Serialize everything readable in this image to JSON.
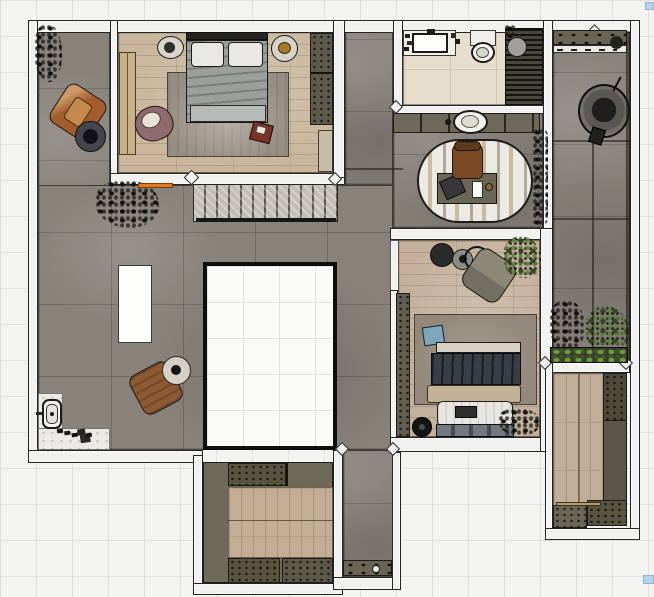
{
  "view": {
    "type": "top-down-floor-plan-render",
    "canvas_width_px": 654,
    "canvas_height_px": 597,
    "visible_text": "none"
  },
  "palette": {
    "background": "#f3f3f1",
    "wall": "#f1f1ef",
    "wall_outline": "#232323",
    "concrete_floor": "#88827b",
    "wood_floor": "#c9b69c",
    "bathroom_marble": "#e7ddcd",
    "entry_marble": "#ebe9e4",
    "cabinet_olive": "#6e695a",
    "cabinet_olive_dark": "#59533f",
    "void_fill": "#fafaf9",
    "accent_orange_mat": "#e5791e",
    "bed2_duvet_navy": "#383e45",
    "bed2_blanket_beige": "#c2b097",
    "cushion_blue": "#7fa6ba",
    "armchair_leather": "#a35d2c",
    "armchair_mauve": "#8d6a6e",
    "plant_green": "#5d8038",
    "selection_handle_blue": "#b7d2ea"
  },
  "rooms": [
    {
      "id": "bedroom-1",
      "area": "top-left",
      "floor": "wood-plank",
      "furniture": [
        "double-bed",
        "pillow-left",
        "pillow-right",
        "nightstand-left",
        "nightstand-right",
        "area-rug",
        "mauve-armchair",
        "red-side-tray",
        "olive-wardrobe",
        "wall-bench",
        "light-dresser"
      ]
    },
    {
      "id": "living-hall",
      "area": "left-center",
      "floor": "concrete-tile",
      "furniture": [
        "staircase",
        "void-opening",
        "white-island",
        "leather-armchair-top",
        "round-side-table-dark",
        "leather-armchair-bottom",
        "round-side-table-light",
        "orange-door-mat",
        "floor-plant-top-left",
        "floor-plant-by-stairs"
      ]
    },
    {
      "id": "entry",
      "area": "bottom-left",
      "floor": "white-marble",
      "furniture": [
        "sanitary-fixture",
        "scattered-shoes"
      ]
    },
    {
      "id": "bathroom",
      "area": "top-center",
      "floor": "marble-tile",
      "furniture": [
        "vanity-counter",
        "rect-sink",
        "toilet",
        "shower-slatted-floor",
        "rain-shower-head",
        "corner-plant"
      ]
    },
    {
      "id": "hall-vanity",
      "area": "center",
      "floor": "concrete-tile",
      "furniture": [
        "cabinet-row",
        "round-vessel-sink"
      ]
    },
    {
      "id": "office-nook",
      "area": "center",
      "floor": "concrete-tile",
      "furniture": [
        "oval-striped-rug",
        "desk",
        "desk-chair",
        "laptop",
        "notepad",
        "cup",
        "wall-planter-strip"
      ]
    },
    {
      "id": "bedroom-2",
      "area": "center-right",
      "floor": "wood-plank",
      "furniture": [
        "double-bed-navy",
        "headboard",
        "beige-blanket",
        "white-foot-duvet",
        "bed-tray",
        "storage-bench",
        "area-rug",
        "blue-cushion",
        "gray-lounge-chair",
        "side-table-black",
        "side-table-gray",
        "ring-table",
        "green-plant",
        "olive-wardrobe",
        "floor-fan",
        "dark-floor-plant"
      ]
    },
    {
      "id": "terrace",
      "area": "right",
      "floor": "concrete-tile",
      "furniture": [
        "top-shelf-bench",
        "window-sill-clutter",
        "hanging-chair",
        "dark-plant",
        "green-plant",
        "planter-box"
      ]
    },
    {
      "id": "walk-in-closet",
      "area": "bottom-center",
      "floor": "wood-plank",
      "furniture": [
        "perimeter-cabinets",
        "speckled-cabinet-sections"
      ]
    },
    {
      "id": "closet-2",
      "area": "bottom-right",
      "floor": "wood-plank",
      "furniture": [
        "side-cabinet",
        "bottom-cabinets"
      ]
    },
    {
      "id": "corridor",
      "area": "bottom-center-right",
      "floor": "concrete-tile",
      "furniture": [
        "console-shelf-with-items"
      ]
    }
  ],
  "ui": {
    "selection_handles": [
      {
        "id": "handle-top-right",
        "x": 645,
        "y": 2
      },
      {
        "id": "handle-bottom-right",
        "x": 643,
        "y": 575
      }
    ]
  }
}
